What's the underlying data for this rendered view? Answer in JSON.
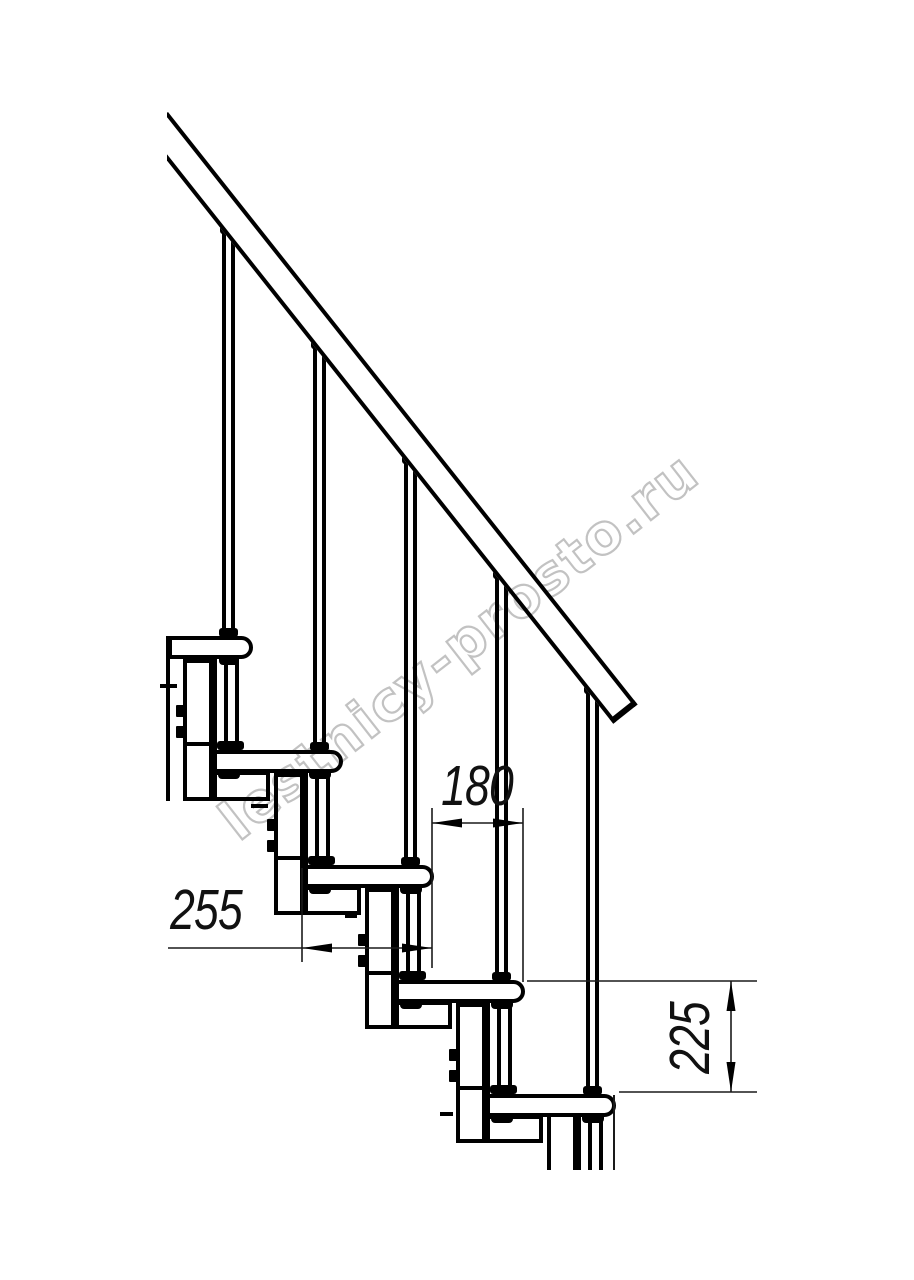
{
  "title": "Staircase side elevation drawing",
  "watermark": {
    "text": "lestnicy-prosto.ru"
  },
  "dimensions": {
    "tread_run": {
      "label": "180"
    },
    "tread_depth": {
      "label": "255"
    },
    "step_rise": {
      "label": "225"
    }
  },
  "colors": {
    "line": "#000000",
    "thin_line": "#1a1a1a",
    "watermark": "#b8b8b8",
    "background": "#ffffff"
  }
}
